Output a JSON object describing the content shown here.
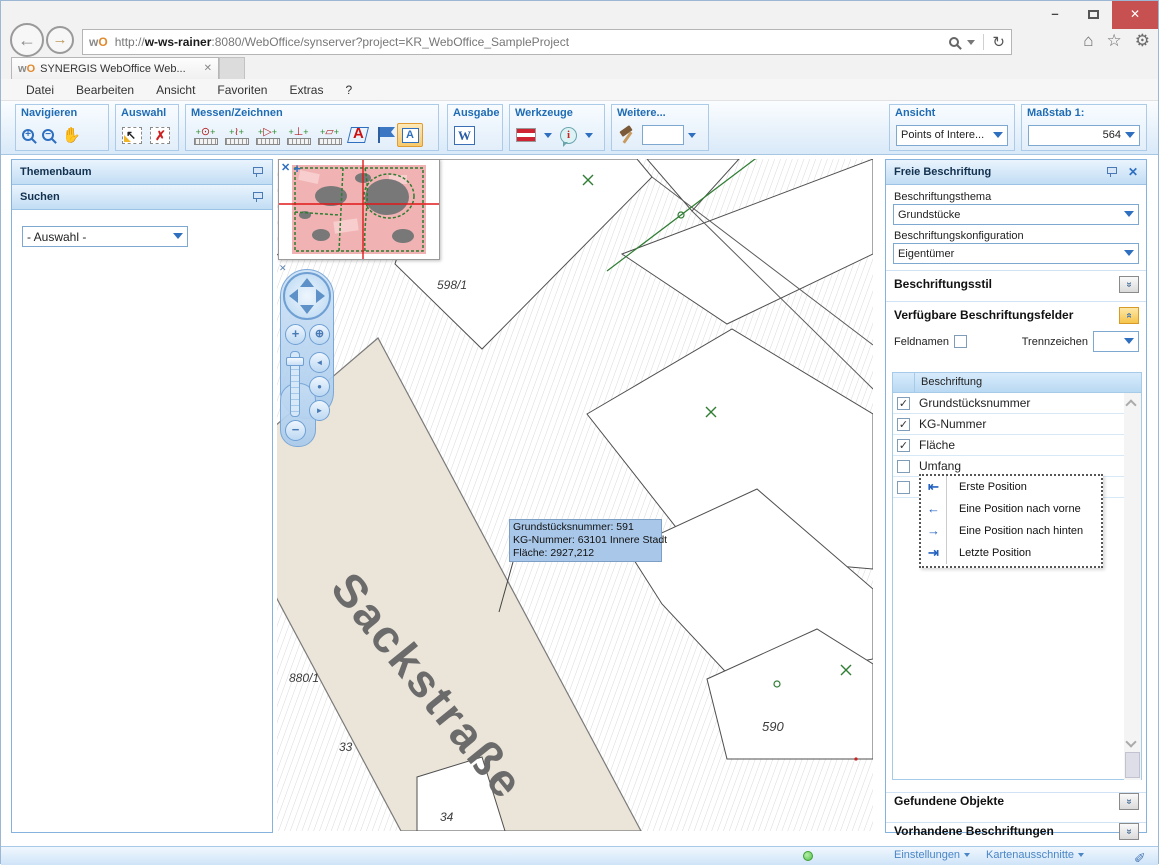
{
  "colors": {
    "accent_blue": "#2e6fc0",
    "close_red": "#c75050",
    "status_green": "#54c04a",
    "tooltip_blue": "#a9c7e8",
    "active_tool_orange": "#f8c96a"
  },
  "browser": {
    "url_scheme": "http://",
    "url_host": "w-ws-rainer",
    "url_rest": ":8080/WebOffice/synserver?project=KR_WebOffice_SampleProject",
    "favicon_w": "w",
    "favicon_o": "O",
    "tab_title": "SYNERGIS WebOffice Web...",
    "menu": [
      "Datei",
      "Bearbeiten",
      "Ansicht",
      "Favoriten",
      "Extras",
      "?"
    ]
  },
  "toolbar": {
    "navigieren": "Navigieren",
    "auswahl": "Auswahl",
    "messen": "Messen/Zeichnen",
    "ausgabe": "Ausgabe",
    "werkzeuge": "Werkzeuge",
    "weitere": "Weitere...",
    "weitere_input": "",
    "ansicht": "Ansicht",
    "ansicht_value": "Points of Intere...",
    "massstab": "Maßstab 1:",
    "massstab_value": "564"
  },
  "left_panel": {
    "themenbaum": "Themenbaum",
    "suchen": "Suchen",
    "auswahl_value": "- Auswahl -"
  },
  "map": {
    "street": "Sackstraße",
    "labels": {
      "p598": "598/1",
      "p880": "880/1",
      "p33": "33",
      "p34": "34",
      "p590": "590"
    },
    "tooltip": {
      "line1": "Grundstücksnummer: 591",
      "line2": "KG-Nummer: 63101 Innere Stadt",
      "line3": "Fläche: 2927,212"
    }
  },
  "right_panel": {
    "title": "Freie Beschriftung",
    "thema_label": "Beschriftungsthema",
    "thema_value": "Grundstücke",
    "konfig_label": "Beschriftungskonfiguration",
    "konfig_value": "Eigentümer",
    "stil": "Beschriftungsstil",
    "felder": "Verfügbare Beschriftungsfelder",
    "feldnamen": "Feldnamen",
    "trennzeichen": "Trennzeichen",
    "trennzeichen_value": "",
    "list_header": "Beschriftung",
    "fields": [
      {
        "label": "Grundstücksnummer",
        "mark": "✓"
      },
      {
        "label": "KG-Nummer",
        "mark": "✓"
      },
      {
        "label": "Fläche",
        "mark": "✓"
      },
      {
        "label": "Umfang",
        "mark": ""
      },
      {
        "label": "",
        "mark": ""
      }
    ],
    "context_menu": [
      {
        "icon": "first-position-icon",
        "label": "Erste Position"
      },
      {
        "icon": "position-forward-icon",
        "label": "Eine Position nach vorne"
      },
      {
        "icon": "position-backward-icon",
        "label": "Eine Position nach hinten"
      },
      {
        "icon": "last-position-icon",
        "label": "Letzte Position"
      }
    ],
    "gefundene": "Gefundene Objekte",
    "vorhandene": "Vorhandene Beschriftungen"
  },
  "statusbar": {
    "einstellungen": "Einstellungen",
    "kartenausschnitte": "Kartenausschnitte"
  }
}
